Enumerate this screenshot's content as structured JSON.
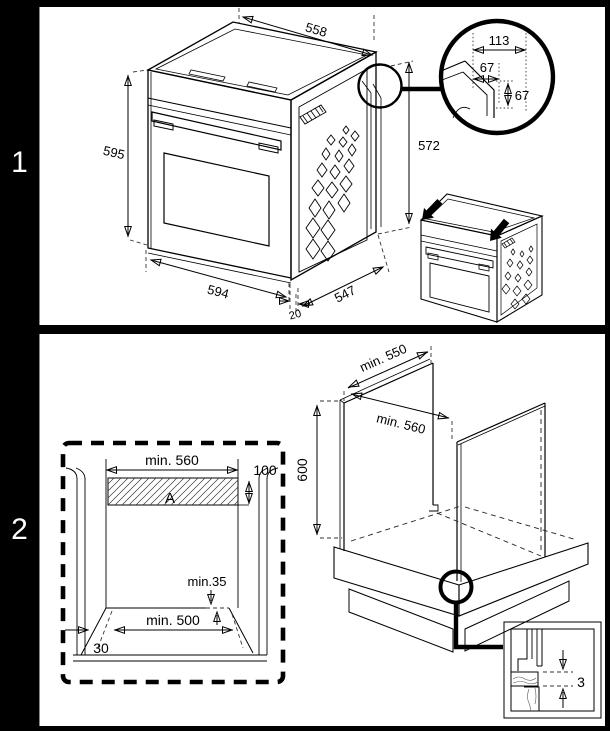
{
  "steps": {
    "step1": "1",
    "step2": "2"
  },
  "panel1": {
    "oven": {
      "top_width": "558",
      "front_height": "595",
      "body_height": "572",
      "front_width": "594",
      "depth": "547",
      "door_protrusion": "20"
    },
    "corner_detail": {
      "total_width": "113",
      "chamfer_width": "67",
      "chamfer_height": "67"
    }
  },
  "panel2": {
    "cutout_front": {
      "niche_width": "min. 560",
      "vent_height": "100",
      "vent_area_label": "A",
      "rear_clearance": "min.35",
      "plinth_opening_width": "min. 500",
      "plinth_depth": "30"
    },
    "cabinet_iso": {
      "min_depth": "min. 550",
      "min_width": "min. 560",
      "side_height": "600",
      "rear_gap": "3"
    }
  }
}
